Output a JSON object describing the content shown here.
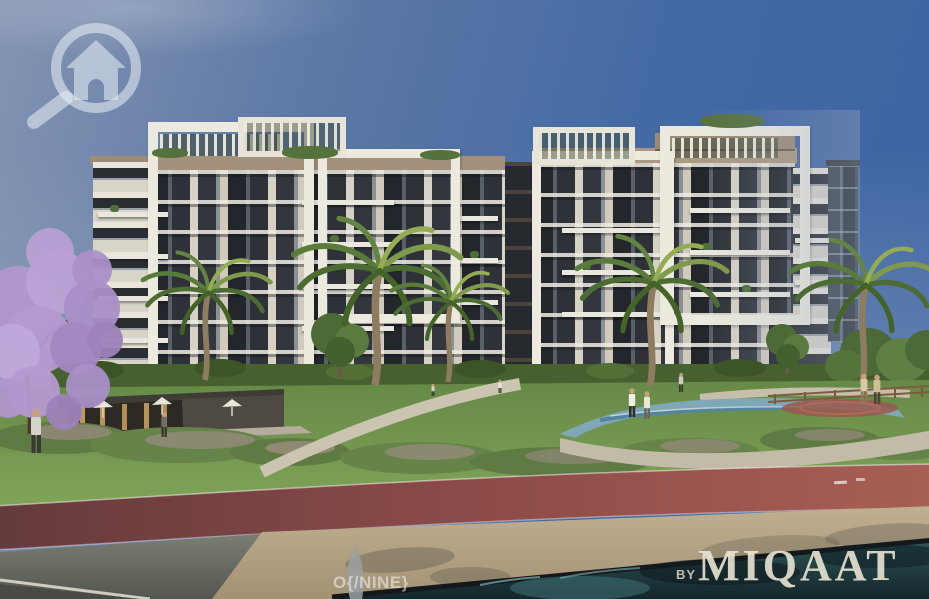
{
  "watermarks": {
    "logo_name": "magnifier-house-logo",
    "center_text": "O{/NINE}",
    "byline_prefix": "BY",
    "brand": "MIQAAT"
  },
  "palette": {
    "sky_top": "#3c64a3",
    "sky_horizon": "#93a2bc",
    "watermark_white": "#e8eef5",
    "building_frame_white": "#eceade",
    "building_window_dark": "#2e3137",
    "building_roof_tan": "#a4917c",
    "jacaranda_purple": "#b49ad0",
    "palm_green": "#5a7c3a",
    "lawn_green": "#75974f",
    "track_red_left": "#643a3d",
    "track_red_right": "#a85f55",
    "sand_walkway": "#b3a284",
    "asphalt_gray": "#6b6e64",
    "pool_teal": "#24474b",
    "pavilion_light": "#d7ae67"
  },
  "scene": {
    "description": "Exterior render of a modern residential compound: white-framed apartment blocks, rooftop pergolas, palm trees, a purple jacaranda, landscaped park with stream, cafe pavilion, red jogging track, sand walkway and dark reflecting pool",
    "elements": [
      "sky",
      "apartment-buildings",
      "rooftop-pergolas",
      "palm-trees",
      "jacaranda-tree",
      "cafe-pavilion",
      "lawn",
      "flower-shrubs",
      "stream",
      "jogging-track",
      "sand-walkway",
      "asphalt-road",
      "water-pool",
      "pedestrians"
    ]
  }
}
